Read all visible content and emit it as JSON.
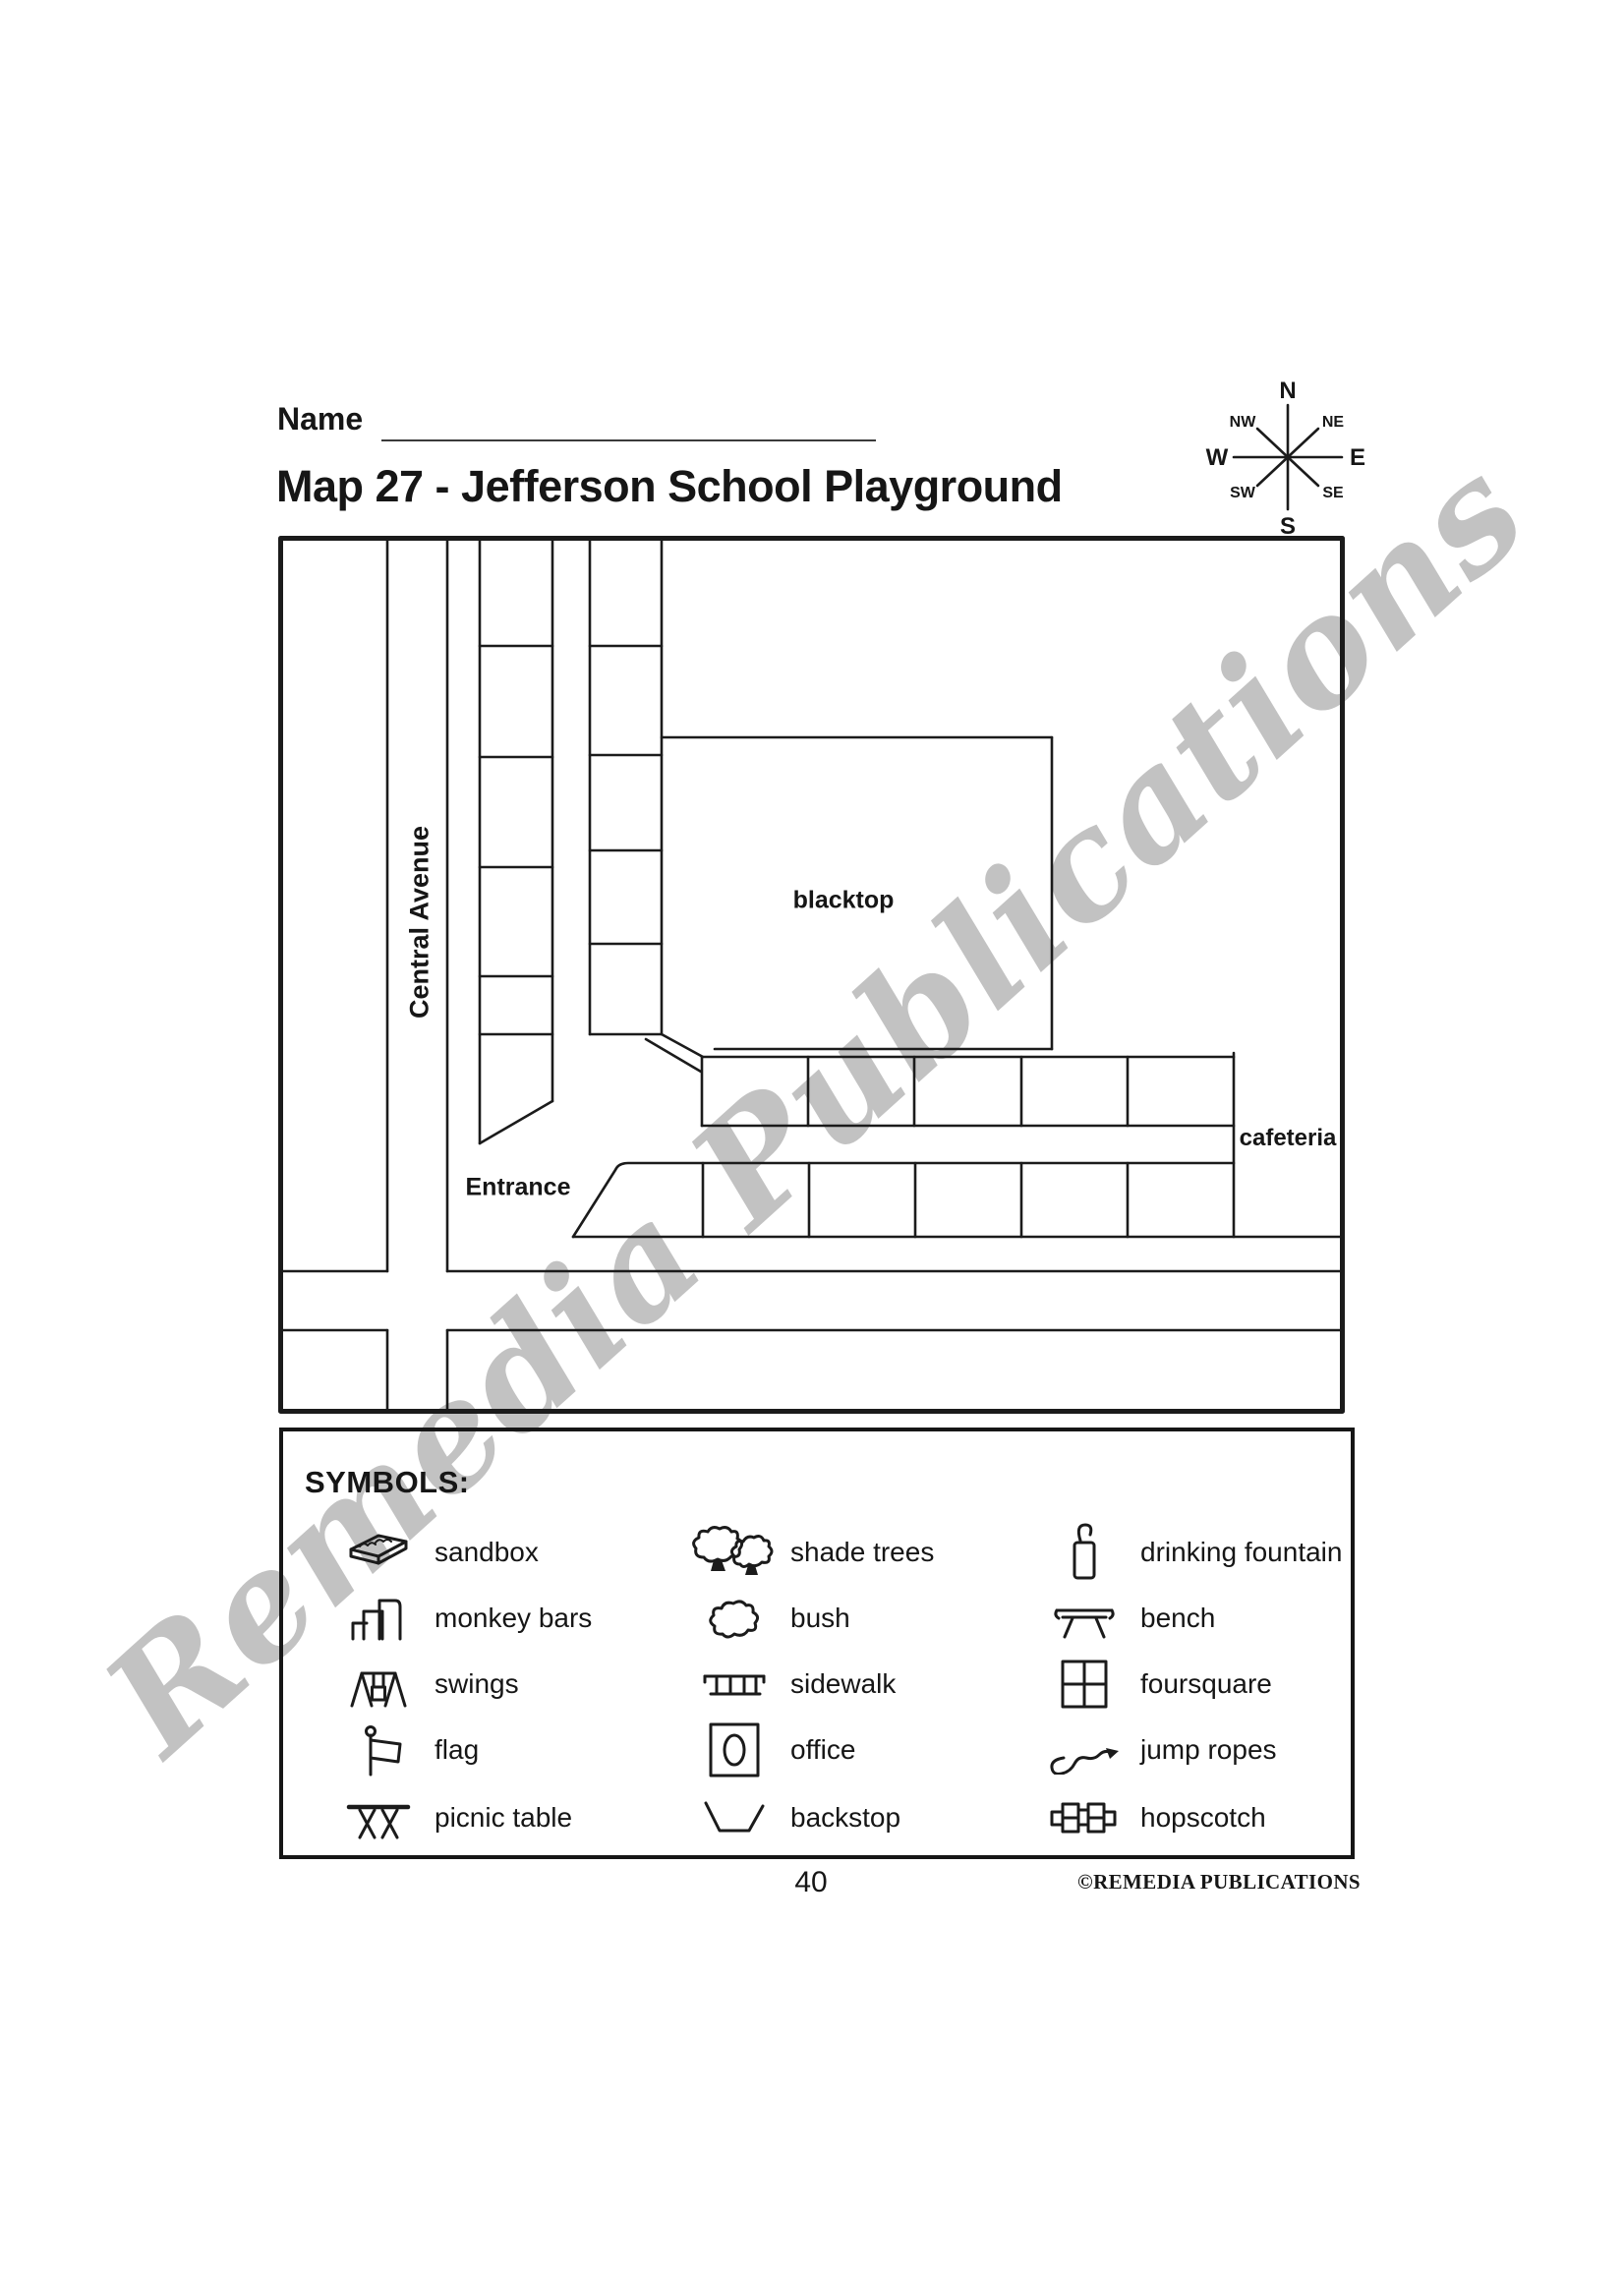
{
  "page": {
    "name_label": "Name",
    "title": "Map 27 - Jefferson School Playground",
    "page_number": "40",
    "copyright": "©REMEDIA PUBLICATIONS"
  },
  "watermark": "Remedia Publications",
  "compass": {
    "n": "N",
    "ne": "NE",
    "e": "E",
    "se": "SE",
    "s": "S",
    "sw": "SW",
    "w": "W",
    "nw": "NW"
  },
  "map": {
    "labels": {
      "central_avenue": "Central Avenue",
      "blacktop": "blacktop",
      "cafeteria": "cafeteria",
      "entrance": "Entrance"
    }
  },
  "legend": {
    "heading": "SYMBOLS:",
    "items": [
      {
        "icon": "sandbox-icon",
        "label": "sandbox"
      },
      {
        "icon": "monkey-bars-icon",
        "label": "monkey bars"
      },
      {
        "icon": "swings-icon",
        "label": "swings"
      },
      {
        "icon": "flag-icon",
        "label": "flag"
      },
      {
        "icon": "picnic-table-icon",
        "label": "picnic table"
      },
      {
        "icon": "shade-trees-icon",
        "label": "shade trees"
      },
      {
        "icon": "bush-icon",
        "label": "bush"
      },
      {
        "icon": "sidewalk-icon",
        "label": "sidewalk"
      },
      {
        "icon": "office-icon",
        "label": "office"
      },
      {
        "icon": "backstop-icon",
        "label": "backstop"
      },
      {
        "icon": "drinking-fountain-icon",
        "label": "drinking fountain"
      },
      {
        "icon": "bench-icon",
        "label": "bench"
      },
      {
        "icon": "foursquare-icon",
        "label": "foursquare"
      },
      {
        "icon": "jump-ropes-icon",
        "label": "jump ropes"
      },
      {
        "icon": "hopscotch-icon",
        "label": "hopscotch"
      }
    ]
  }
}
